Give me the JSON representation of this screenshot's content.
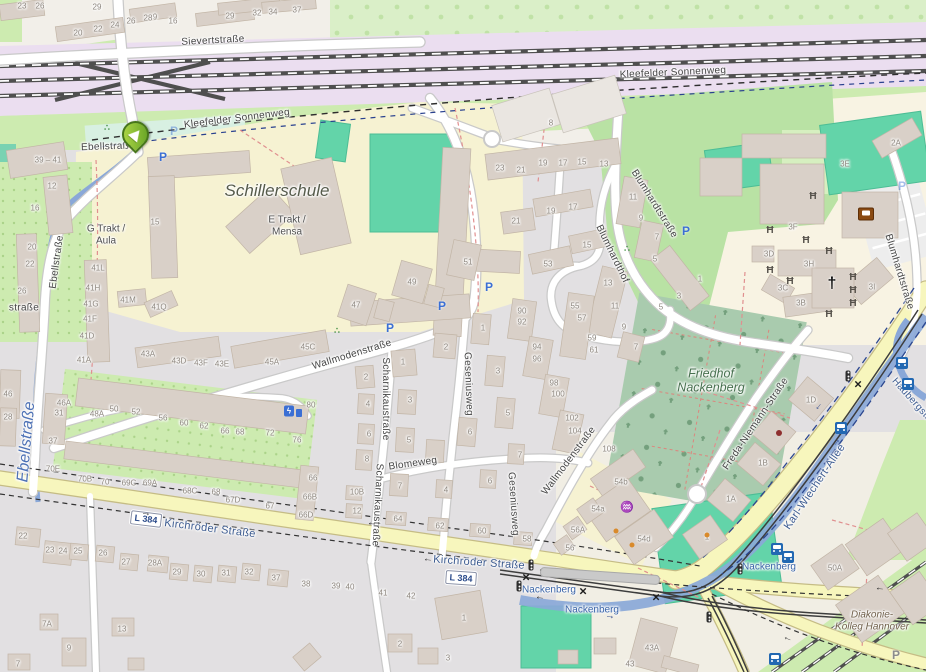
{
  "map": {
    "marker": {
      "name": "current-location",
      "color": "#6fae2a"
    },
    "street_labels": [
      {
        "t": "Sievertstraße",
        "x": 213,
        "y": 41,
        "r": -3
      },
      {
        "t": "Kleefelder Sonnenweg",
        "x": 237,
        "y": 119,
        "r": -7
      },
      {
        "t": "Kleefelder Sonnenweg",
        "x": 673,
        "y": 73,
        "r": -2.5
      },
      {
        "t": "Ebellstraße",
        "x": 108,
        "y": 147,
        "r": -2
      },
      {
        "t": "Ebellstraße",
        "x": 57,
        "y": 262,
        "r": -82
      },
      {
        "t": "straße",
        "x": 24,
        "y": 308,
        "r": 0
      },
      {
        "t": "Wallmodenstraße",
        "x": 352,
        "y": 355,
        "r": -17
      },
      {
        "t": "Wallmodenstraße",
        "x": 569,
        "y": 461,
        "r": -53
      },
      {
        "t": "Scharnikaustraße",
        "x": 385,
        "y": 399,
        "r": 90
      },
      {
        "t": "Scharnikaustraße",
        "x": 377,
        "y": 505,
        "r": 93
      },
      {
        "t": "Geseniusweg",
        "x": 468,
        "y": 384,
        "r": 88
      },
      {
        "t": "Geseniusweg",
        "x": 513,
        "y": 504,
        "r": 86
      },
      {
        "t": "Blomeweg",
        "x": 413,
        "y": 464,
        "r": -8
      },
      {
        "t": "Blumhardtstraße",
        "x": 654,
        "y": 204,
        "r": 58
      },
      {
        "t": "Blumhardtstraße",
        "x": 899,
        "y": 272,
        "r": 73
      },
      {
        "t": "Blumhardthof",
        "x": 612,
        "y": 254,
        "r": 64
      },
      {
        "t": "Freda-Niemann-Straße",
        "x": 756,
        "y": 424,
        "r": -56
      },
      {
        "t": "Karl-Wiechert-Allee",
        "x": 815,
        "y": 487,
        "r": -56,
        "c": "#3d5c91",
        "s": 11
      },
      {
        "t": "Haubergstraße",
        "x": 917,
        "y": 406,
        "r": 48,
        "c": "#3d5c91"
      },
      {
        "t": "Kirchröder Straße",
        "x": 210,
        "y": 529,
        "r": 7,
        "c": "#3d5c91",
        "s": 11
      },
      {
        "t": "Kirchröder Straße",
        "x": 479,
        "y": 563,
        "r": 4,
        "c": "#3d5c91",
        "s": 11
      }
    ],
    "water_labels": [
      {
        "t": "Ebellstraße",
        "x": 27,
        "y": 442,
        "r": -85
      }
    ],
    "transit_stop_labels": [
      {
        "t": "Nackenberg",
        "x": 549,
        "y": 590
      },
      {
        "t": "Nackenberg",
        "x": 592,
        "y": 610
      },
      {
        "t": "Nackenberg",
        "x": 769,
        "y": 567
      }
    ],
    "area_labels": [
      {
        "lines": [
          "Schillerschule"
        ],
        "x": 277,
        "y": 191,
        "s": 17,
        "c": "#565b4b",
        "i": true
      },
      {
        "lines": [
          "G Trakt /",
          "Aula"
        ],
        "x": 106,
        "y": 235,
        "s": 10,
        "c": "#4f4f4f"
      },
      {
        "lines": [
          "E Trakt /",
          "Mensa"
        ],
        "x": 287,
        "y": 226,
        "s": 10,
        "c": "#4f4f4f"
      },
      {
        "lines": [
          "Friedhof",
          "Nackenberg"
        ],
        "x": 711,
        "y": 381,
        "s": 12.5,
        "c": "#47714f",
        "i": true
      },
      {
        "lines": [
          "Diakonie-",
          "Kolleg Hannover"
        ],
        "x": 872,
        "y": 621,
        "s": 10,
        "c": "#70604b",
        "i": true
      }
    ],
    "route_badges": [
      {
        "t": "L 384",
        "x": 146,
        "y": 519,
        "r": 7
      },
      {
        "t": "L 384",
        "x": 461,
        "y": 578,
        "r": 4
      }
    ],
    "house_numbers": [
      [
        "23",
        22,
        6
      ],
      [
        "26",
        40,
        6
      ],
      [
        "29",
        97,
        7
      ],
      [
        "9",
        155,
        17
      ],
      [
        "20",
        78,
        33
      ],
      [
        "22",
        98,
        29
      ],
      [
        "24",
        115,
        25
      ],
      [
        "26",
        131,
        21
      ],
      [
        "28",
        148,
        18
      ],
      [
        "16",
        173,
        21
      ],
      [
        "29",
        230,
        16
      ],
      [
        "32",
        257,
        13
      ],
      [
        "34",
        273,
        12
      ],
      [
        "37",
        297,
        10
      ],
      [
        "39 – 41",
        48,
        160
      ],
      [
        "12",
        52,
        186
      ],
      [
        "16",
        35,
        208
      ],
      [
        "20",
        32,
        247
      ],
      [
        "22",
        30,
        264
      ],
      [
        "26",
        22,
        291
      ],
      [
        "41L",
        98,
        268
      ],
      [
        "41H",
        93,
        288
      ],
      [
        "41G",
        91,
        304
      ],
      [
        "41M",
        128,
        300
      ],
      [
        "41Q",
        159,
        307
      ],
      [
        "41F",
        90,
        319
      ],
      [
        "41D",
        87,
        336
      ],
      [
        "41A",
        84,
        360
      ],
      [
        "43A",
        148,
        354
      ],
      [
        "43D",
        179,
        361
      ],
      [
        "43F",
        201,
        363
      ],
      [
        "43E",
        222,
        364
      ],
      [
        "45A",
        272,
        362
      ],
      [
        "45C",
        308,
        347
      ],
      [
        "15",
        155,
        222
      ],
      [
        "47",
        356,
        305
      ],
      [
        "49",
        412,
        282
      ],
      [
        "51",
        468,
        262
      ],
      [
        "53",
        548,
        264
      ],
      [
        "15",
        587,
        245
      ],
      [
        "8",
        551,
        123
      ],
      [
        "23",
        500,
        168
      ],
      [
        "21",
        521,
        170
      ],
      [
        "19",
        543,
        163
      ],
      [
        "17",
        563,
        163
      ],
      [
        "15",
        582,
        162
      ],
      [
        "13",
        604,
        164
      ],
      [
        "21",
        516,
        221
      ],
      [
        "19",
        551,
        211
      ],
      [
        "17",
        573,
        207
      ],
      [
        "11",
        633,
        197
      ],
      [
        "9",
        641,
        218
      ],
      [
        "7",
        657,
        237
      ],
      [
        "5",
        655,
        259
      ],
      [
        "13",
        608,
        283
      ],
      [
        "11",
        615,
        306
      ],
      [
        "9",
        624,
        327
      ],
      [
        "7",
        636,
        347
      ],
      [
        "5",
        661,
        307
      ],
      [
        "3",
        679,
        296
      ],
      [
        "1",
        700,
        279
      ],
      [
        "55",
        575,
        306
      ],
      [
        "57",
        582,
        318
      ],
      [
        "59",
        592,
        338
      ],
      [
        "61",
        594,
        350
      ],
      [
        "90",
        522,
        311
      ],
      [
        "92",
        522,
        322
      ],
      [
        "94",
        537,
        347
      ],
      [
        "96",
        537,
        359
      ],
      [
        "98",
        554,
        383
      ],
      [
        "100",
        558,
        394
      ],
      [
        "102",
        572,
        418
      ],
      [
        "104",
        575,
        431
      ],
      [
        "1",
        483,
        328
      ],
      [
        "3",
        498,
        371
      ],
      [
        "5",
        508,
        413
      ],
      [
        "6",
        470,
        432
      ],
      [
        "2",
        446,
        347
      ],
      [
        "1",
        403,
        362
      ],
      [
        "2",
        366,
        377
      ],
      [
        "3",
        410,
        400
      ],
      [
        "4",
        368,
        404
      ],
      [
        "5",
        409,
        440
      ],
      [
        "6",
        369,
        434
      ],
      [
        "8",
        367,
        459
      ],
      [
        "7",
        400,
        486
      ],
      [
        "4",
        446,
        490
      ],
      [
        "6",
        490,
        481
      ],
      [
        "7",
        520,
        455
      ],
      [
        "10B",
        357,
        492
      ],
      [
        "12",
        357,
        511
      ],
      [
        "64",
        398,
        519
      ],
      [
        "62",
        440,
        526
      ],
      [
        "60",
        482,
        531
      ],
      [
        "58",
        527,
        539
      ],
      [
        "3E",
        845,
        164
      ],
      [
        "2A",
        896,
        143
      ],
      [
        "3F",
        793,
        227
      ],
      [
        "3D",
        769,
        254
      ],
      [
        "3H",
        809,
        264
      ],
      [
        "3C",
        783,
        288
      ],
      [
        "3B",
        801,
        303
      ],
      [
        "3I",
        872,
        287
      ],
      [
        "108",
        609,
        449
      ],
      [
        "54b",
        621,
        482
      ],
      [
        "1D",
        811,
        400
      ],
      [
        "1B",
        763,
        463
      ],
      [
        "1A",
        731,
        499
      ],
      [
        "54a",
        598,
        509
      ],
      [
        "56A",
        578,
        530
      ],
      [
        "56",
        570,
        548
      ],
      [
        "54d",
        644,
        539
      ],
      [
        "1",
        707,
        537
      ],
      [
        "50A",
        835,
        568
      ],
      [
        "43A",
        652,
        648
      ],
      [
        "43",
        630,
        664
      ],
      [
        "46",
        8,
        394
      ],
      [
        "46A",
        64,
        403
      ],
      [
        "31",
        59,
        413
      ],
      [
        "28",
        8,
        417
      ],
      [
        "37",
        53,
        441
      ],
      [
        "70E",
        53,
        469
      ],
      [
        "70B",
        85,
        479
      ],
      [
        "70",
        105,
        482
      ],
      [
        "69C",
        129,
        483
      ],
      [
        "69A",
        150,
        483
      ],
      [
        "48A",
        97,
        414
      ],
      [
        "50",
        114,
        409
      ],
      [
        "52",
        136,
        412
      ],
      [
        "56",
        163,
        418
      ],
      [
        "60",
        184,
        423
      ],
      [
        "62",
        204,
        426
      ],
      [
        "66",
        225,
        431
      ],
      [
        "68",
        240,
        432
      ],
      [
        "72",
        270,
        433
      ],
      [
        "76",
        297,
        440
      ],
      [
        "80",
        311,
        405
      ],
      [
        "68C",
        190,
        491
      ],
      [
        "68",
        216,
        492
      ],
      [
        "67D",
        233,
        500
      ],
      [
        "67",
        270,
        506
      ],
      [
        "66",
        313,
        478
      ],
      [
        "66B",
        310,
        497
      ],
      [
        "66D",
        306,
        515
      ],
      [
        "22",
        23,
        536
      ],
      [
        "23",
        50,
        550
      ],
      [
        "24",
        63,
        551
      ],
      [
        "25",
        78,
        551
      ],
      [
        "26",
        103,
        553
      ],
      [
        "27",
        126,
        562
      ],
      [
        "28A",
        155,
        563
      ],
      [
        "29",
        177,
        572
      ],
      [
        "30",
        201,
        574
      ],
      [
        "31",
        226,
        573
      ],
      [
        "32",
        249,
        572
      ],
      [
        "37",
        276,
        578
      ],
      [
        "38",
        306,
        584
      ],
      [
        "39",
        336,
        586
      ],
      [
        "40",
        350,
        587
      ],
      [
        "41",
        383,
        593
      ],
      [
        "42",
        411,
        596
      ],
      [
        "1",
        464,
        618
      ],
      [
        "2",
        400,
        644
      ],
      [
        "3",
        448,
        658
      ],
      [
        "7A",
        47,
        624
      ],
      [
        "13",
        122,
        629
      ],
      [
        "9",
        69,
        648
      ],
      [
        "7",
        18,
        664
      ]
    ],
    "icons": {
      "parking": [
        [
          174,
          131,
          "faded"
        ],
        [
          163,
          157,
          ""
        ],
        [
          390,
          328,
          ""
        ],
        [
          442,
          306,
          ""
        ],
        [
          489,
          287,
          ""
        ],
        [
          686,
          231,
          ""
        ],
        [
          902,
          186,
          "faded"
        ],
        [
          896,
          655,
          "gray"
        ]
      ],
      "playground": [
        [
          107,
          128
        ],
        [
          337,
          331
        ],
        [
          627,
          249
        ]
      ],
      "picnic": [
        [
          813,
          197
        ],
        [
          770,
          231
        ],
        [
          806,
          241
        ],
        [
          829,
          252
        ],
        [
          770,
          271
        ],
        [
          790,
          282
        ],
        [
          853,
          278
        ],
        [
          853,
          291
        ],
        [
          853,
          304
        ],
        [
          829,
          315
        ]
      ],
      "church": [
        [
          832,
          284
        ]
      ],
      "library": [
        [
          866,
          214
        ]
      ],
      "charging": [
        [
          289,
          411
        ]
      ],
      "watertap": [
        [
          299,
          413
        ]
      ],
      "fountain": [
        [
          627,
          508
        ]
      ],
      "bus": [
        [
          902,
          363
        ],
        [
          908,
          384
        ],
        [
          841,
          428
        ],
        [
          777,
          549
        ],
        [
          788,
          557
        ],
        [
          775,
          659
        ]
      ],
      "signal": [
        [
          531,
          565
        ],
        [
          519,
          586
        ],
        [
          740,
          569
        ],
        [
          709,
          617
        ],
        [
          848,
          376
        ]
      ],
      "crossx": [
        [
          526,
          577
        ],
        [
          583,
          591
        ],
        [
          656,
          597
        ],
        [
          858,
          384
        ]
      ],
      "reddot": [
        [
          779,
          433
        ]
      ],
      "orangedot": [
        [
          707,
          535
        ],
        [
          616,
          531
        ],
        [
          632,
          545
        ]
      ]
    },
    "oneway_arrows": [
      {
        "t": "→",
        "x": 146,
        "y": 513,
        "r": 8,
        "c": "#333333"
      },
      {
        "t": "←",
        "x": 372,
        "y": 523,
        "r": 7,
        "c": "#333333"
      },
      {
        "t": "←",
        "x": 428,
        "y": 559,
        "r": 6,
        "c": "#333333"
      },
      {
        "t": "←",
        "x": 540,
        "y": 597,
        "r": 8,
        "c": "#333333"
      },
      {
        "t": "→",
        "x": 610,
        "y": 616,
        "r": 8,
        "c": "#2c478f"
      },
      {
        "t": "←",
        "x": 818,
        "y": 406,
        "r": -52,
        "c": "#2c478f"
      },
      {
        "t": "→",
        "x": 836,
        "y": 442,
        "r": -52,
        "c": "#2c478f"
      },
      {
        "t": "←",
        "x": 788,
        "y": 638,
        "r": 22,
        "c": "#333333"
      },
      {
        "t": "←",
        "x": 880,
        "y": 588,
        "r": 5,
        "c": "#333333"
      }
    ],
    "glyphs": {
      "parking": "P",
      "playground": "∴",
      "picnic": "Ħ",
      "church": "†",
      "charging": "ϟ",
      "fountain": "♒",
      "crossx": "×"
    }
  }
}
